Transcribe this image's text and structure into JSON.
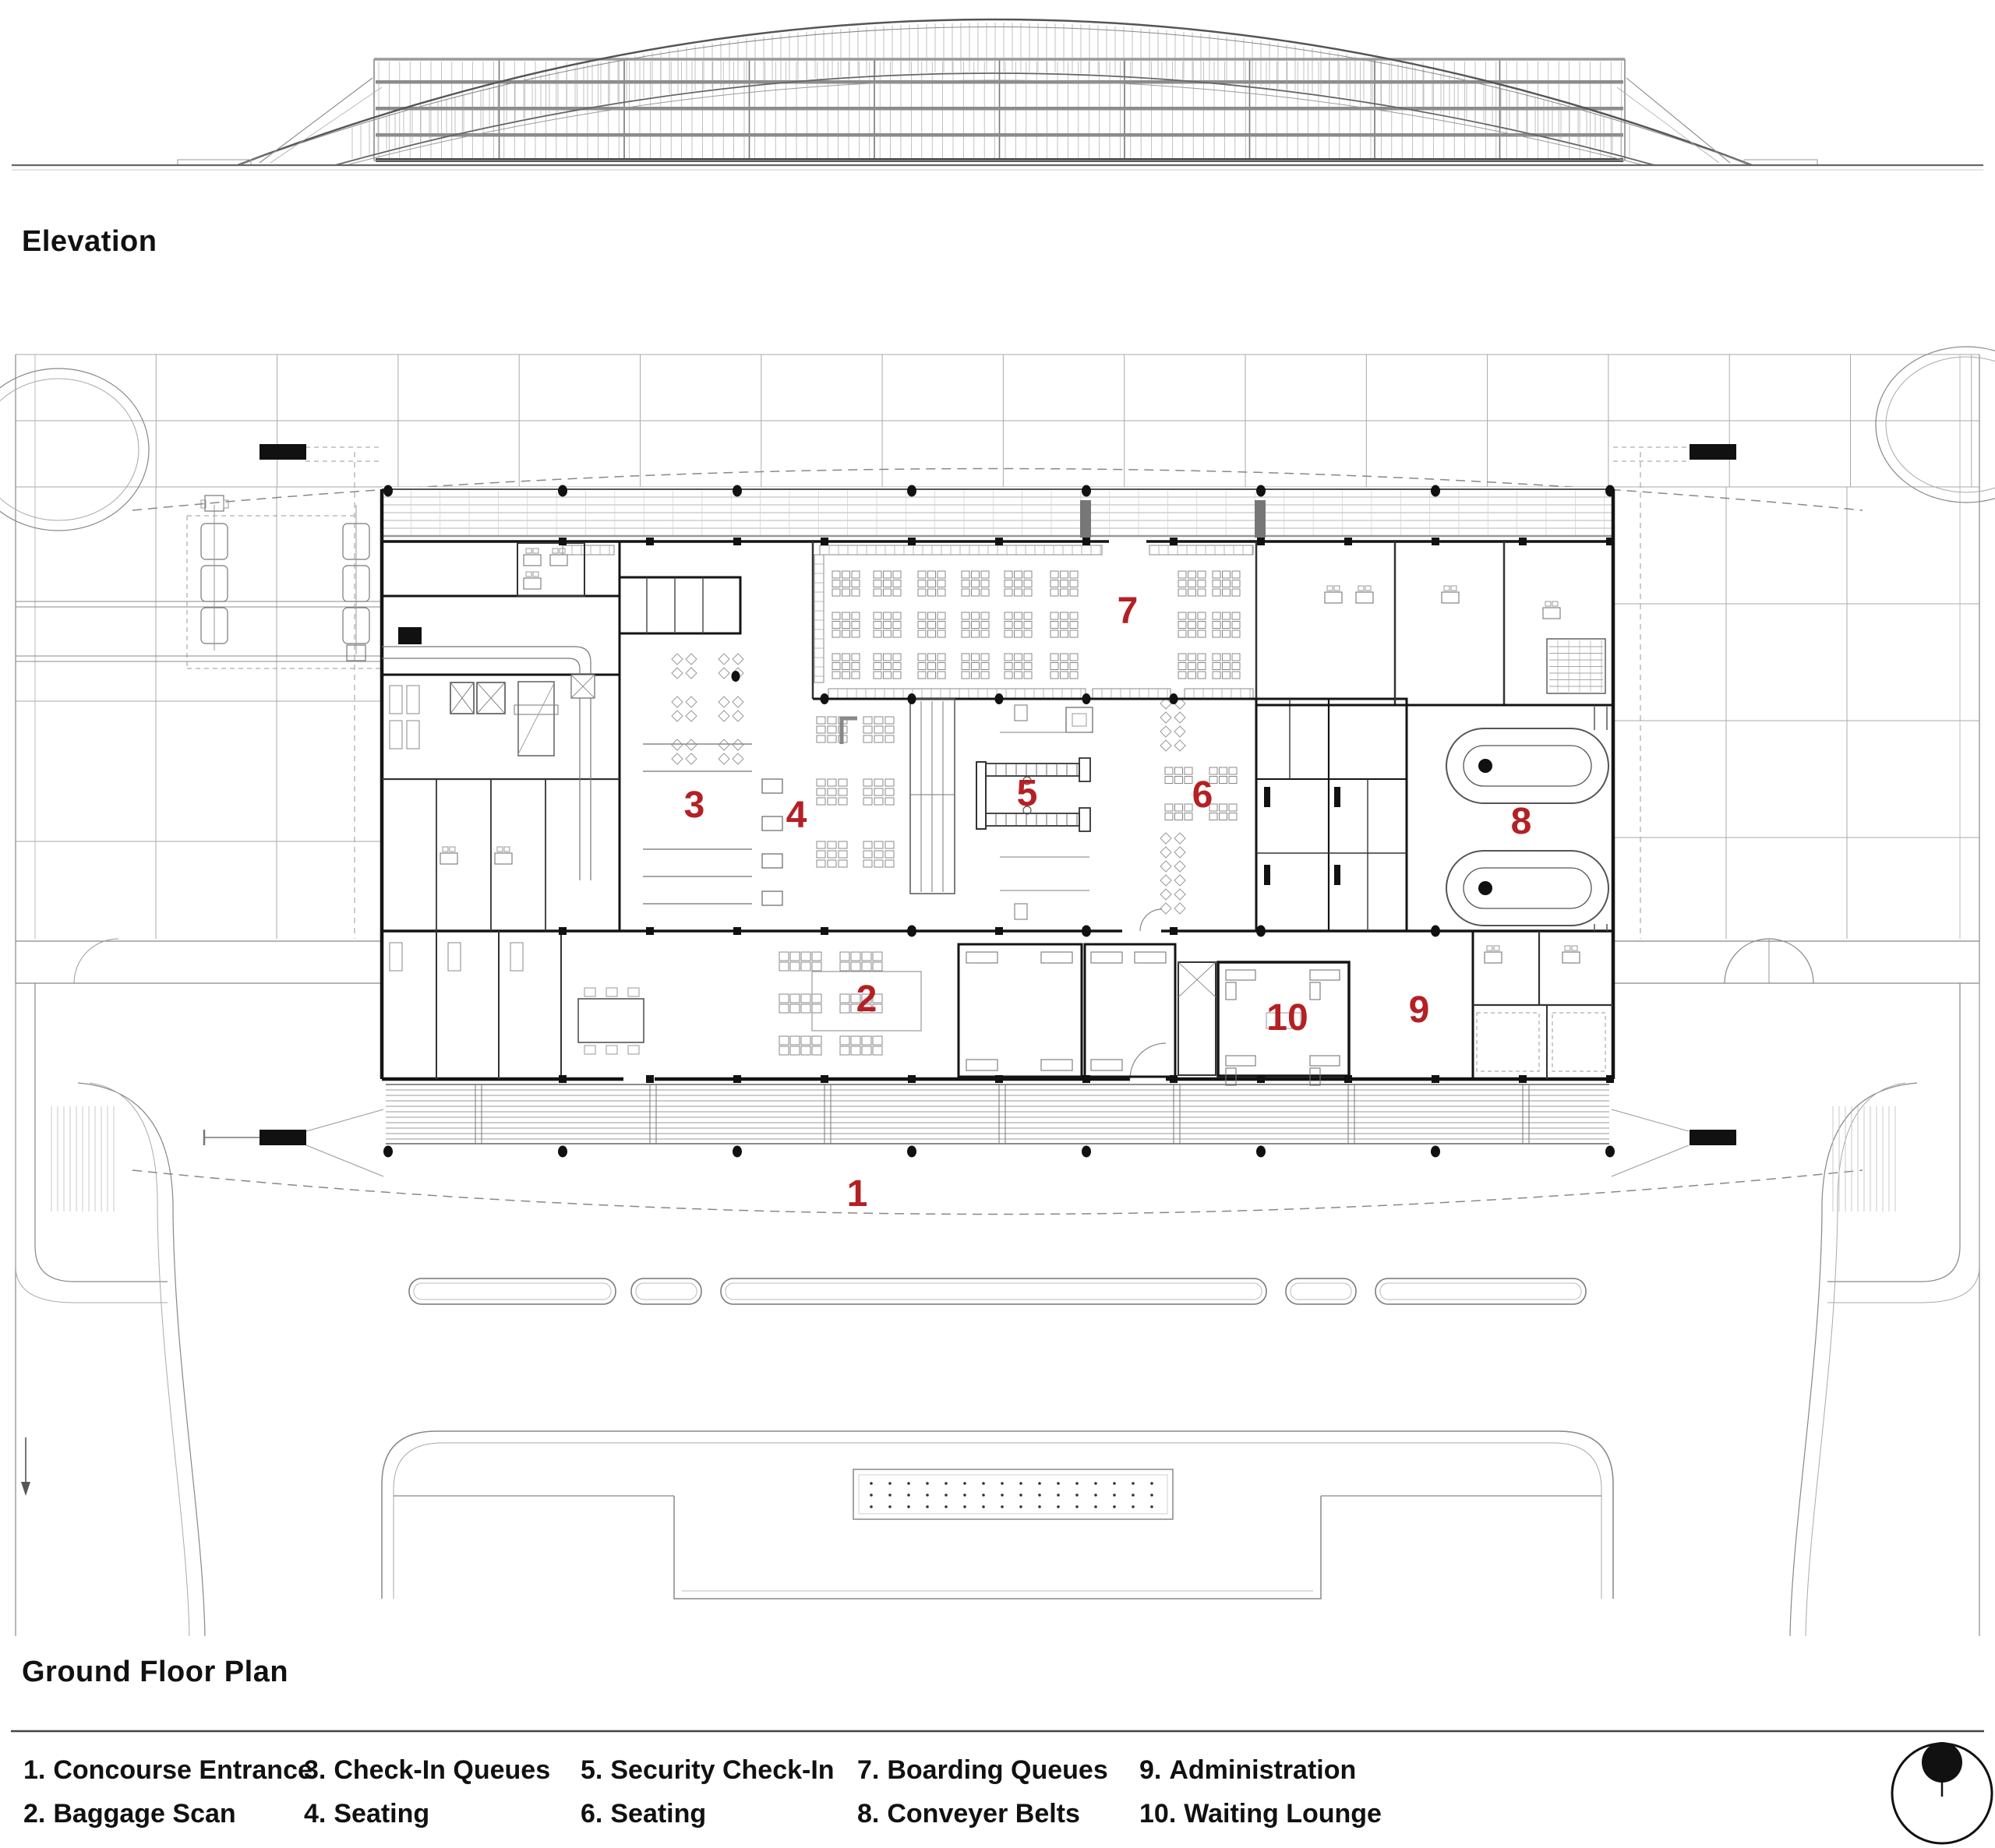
{
  "labels": {
    "elevation": "Elevation",
    "ground_floor_plan": "Ground Floor Plan"
  },
  "plan_numbers": [
    "1",
    "2",
    "3",
    "4",
    "5",
    "6",
    "7",
    "8",
    "9",
    "10"
  ],
  "legend": {
    "items": [
      {
        "num": "1.",
        "label": "Concourse Entrance"
      },
      {
        "num": "2.",
        "label": "Baggage Scan"
      },
      {
        "num": "3.",
        "label": "Check-In Queues"
      },
      {
        "num": "4.",
        "label": "Seating"
      },
      {
        "num": "5.",
        "label": "Security Check-In"
      },
      {
        "num": "6.",
        "label": "Seating"
      },
      {
        "num": "7.",
        "label": "Boarding Queues"
      },
      {
        "num": "8.",
        "label": "Conveyer Belts"
      },
      {
        "num": "9.",
        "label": "Administration"
      },
      {
        "num": "10.",
        "label": "Waiting Lounge"
      }
    ]
  },
  "icons": {
    "north": "north-arrow-icon"
  },
  "colors": {
    "accent_red": "#b42025",
    "ink": "#141414",
    "line_mid": "#666666",
    "line_light": "#999999"
  }
}
